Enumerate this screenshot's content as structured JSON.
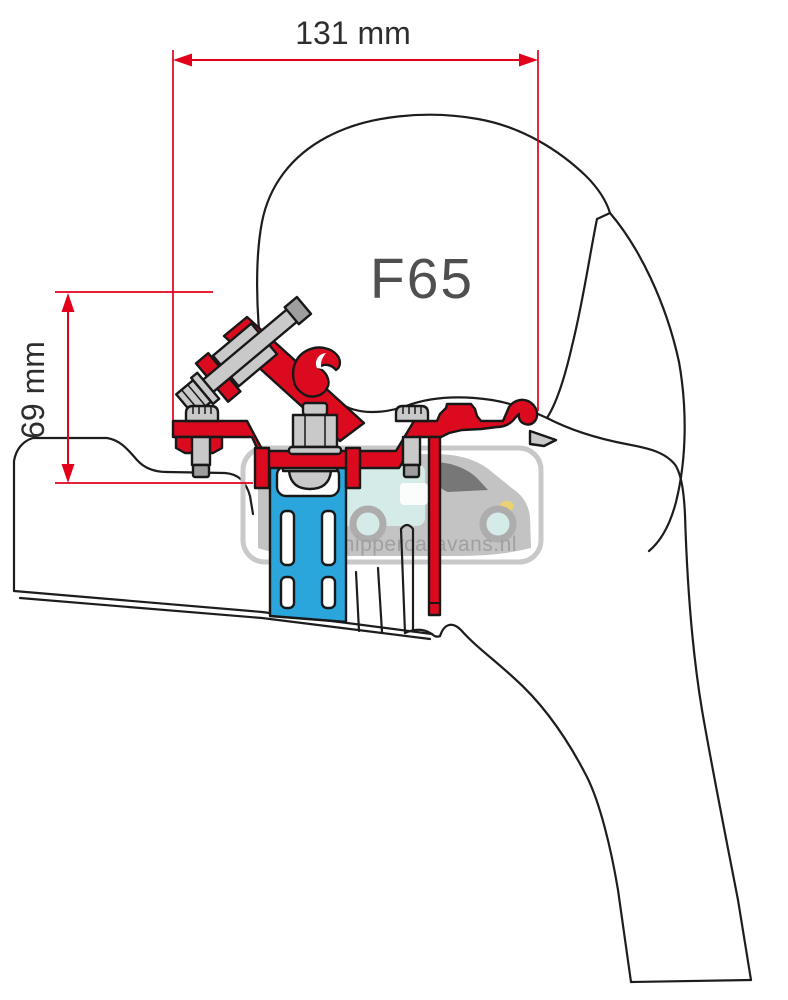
{
  "diagram": {
    "product_label": "F65",
    "dimension_width": "131 mm",
    "dimension_height": "69 mm",
    "watermark_text": "Schippercaravans.nl"
  },
  "colors": {
    "bracket_red": "#dc0a1e",
    "dimension_red": "#e2001a",
    "rail_blue": "#2ba6dd",
    "bolt_gray": "#c9c9c9",
    "bolt_dark_gray": "#9e9e9e",
    "outline_dark": "#1d1d1d",
    "product_label_gray": "#4f4f4f",
    "dimension_text_dark": "#2e2e2e",
    "watermark_border_gray": "#c6c6c6",
    "watermark_text_gray": "#9b9b9b",
    "watermark_teal": "#d3eae6",
    "watermark_van_gray": "#b9b9b9",
    "headlight_yellow": "#e9d06b"
  }
}
